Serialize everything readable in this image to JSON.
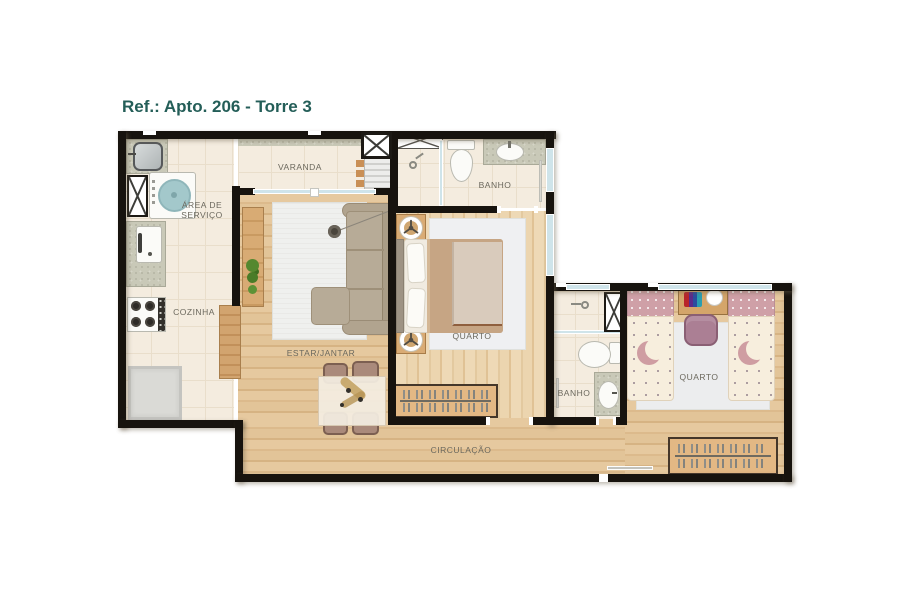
{
  "title": "Ref.: Apto. 206 - Torre 3",
  "labels": {
    "varanda": "VARANDA",
    "area_servico": "ÁREA DE SERVIÇO",
    "cozinha": "COZINHA",
    "estar_jantar": "ESTAR/JANTAR",
    "banho_suite": "BANHO",
    "quarto_casal": "QUARTO",
    "banho_social": "BANHO",
    "quarto_solteiro": "QUARTO",
    "circulacao": "CIRCULAÇÃO"
  },
  "colors": {
    "title_text": "#245e58",
    "walls": "#17130e",
    "wood_floor": "#e3c49b",
    "tile_floor": "#f4ecdf",
    "window_glass": "#cfe4ea",
    "washer_teal": "#a3c8cb",
    "label_text": "#6b685d"
  }
}
